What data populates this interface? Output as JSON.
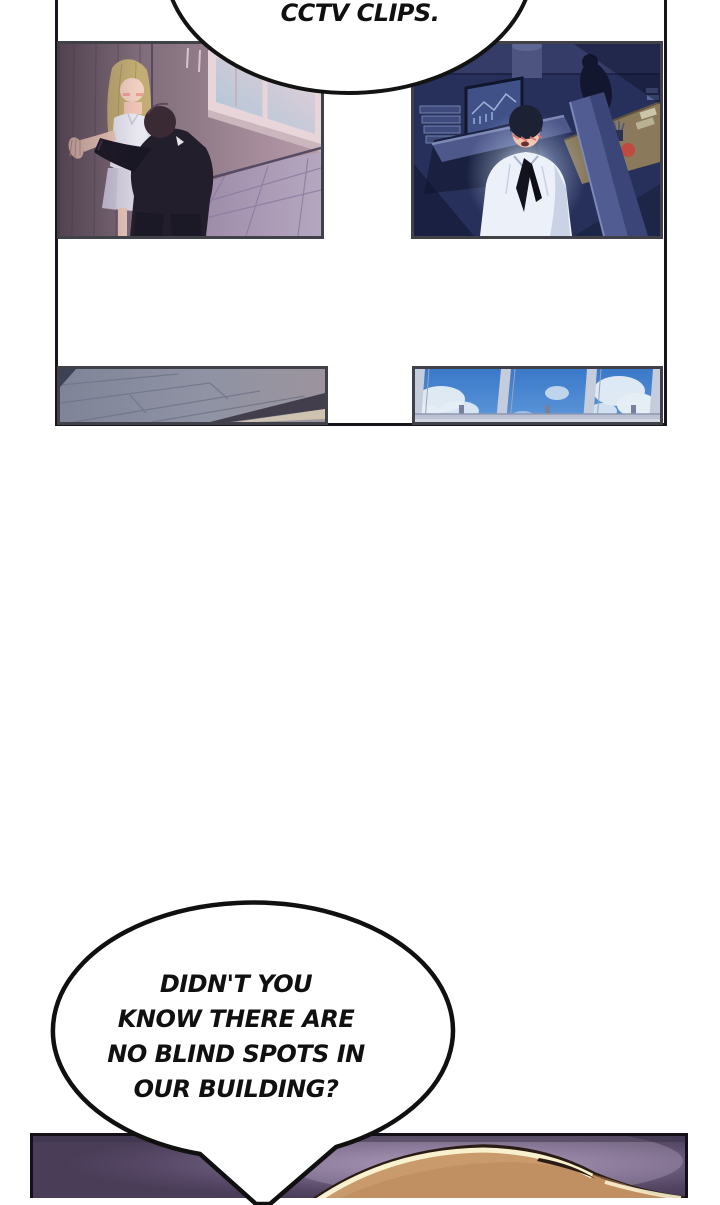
{
  "page": {
    "width": 720,
    "height": 1198,
    "background": "#ffffff",
    "kind": "webtoon comic page"
  },
  "speech_bubbles": {
    "top": {
      "text": "CCTV CLIPS."
    },
    "bottom": {
      "lines": [
        "DIDN'T YOU",
        "KNOW THERE ARE",
        "NO BLIND SPOTS IN",
        "OUR BUILDING?"
      ]
    }
  },
  "panels": {
    "top_left": {
      "alt": "dusk corner: man in dark suit leaning toward blonde woman against wood wall, window upper right"
    },
    "top_right": {
      "alt": "night office cubicles: flushed man in white shirt with loose black tie lit by monitor glow"
    },
    "bottom_left": {
      "alt": "grey ceiling panels seen at a tilted angle"
    },
    "bottom_right": {
      "alt": "office windows from below with blue sky and clouds"
    },
    "bottom_strip": {
      "alt": "top of light-brown hair against purple glow, cut off by page bottom"
    }
  },
  "palette": {
    "outer_border": "#17141b",
    "panel_border": "#414149",
    "bubble_fill": "#ffffff",
    "bubble_stroke": "#101010",
    "tl_wall_dark": "#6a5966",
    "tl_wall_light": "#b294a2",
    "tl_sky": "#aac6da",
    "tl_floor": "#a795b2",
    "tr_bg": "#27305a",
    "tr_partition": "#4e588a",
    "tr_desk": "#8a7a5b",
    "tr_shirt": "#ecf0f8",
    "bl_ceiling": "#8f93a4",
    "br_sky": "#3f80cf",
    "br_frame": "#c5ccdb",
    "bottom_bg": "#584a68",
    "bottom_glow": "#a593b6",
    "hair_tan": "#c89a6c",
    "hair_highlight": "#f9f0cd",
    "hair_outline": "#2a1c14"
  }
}
